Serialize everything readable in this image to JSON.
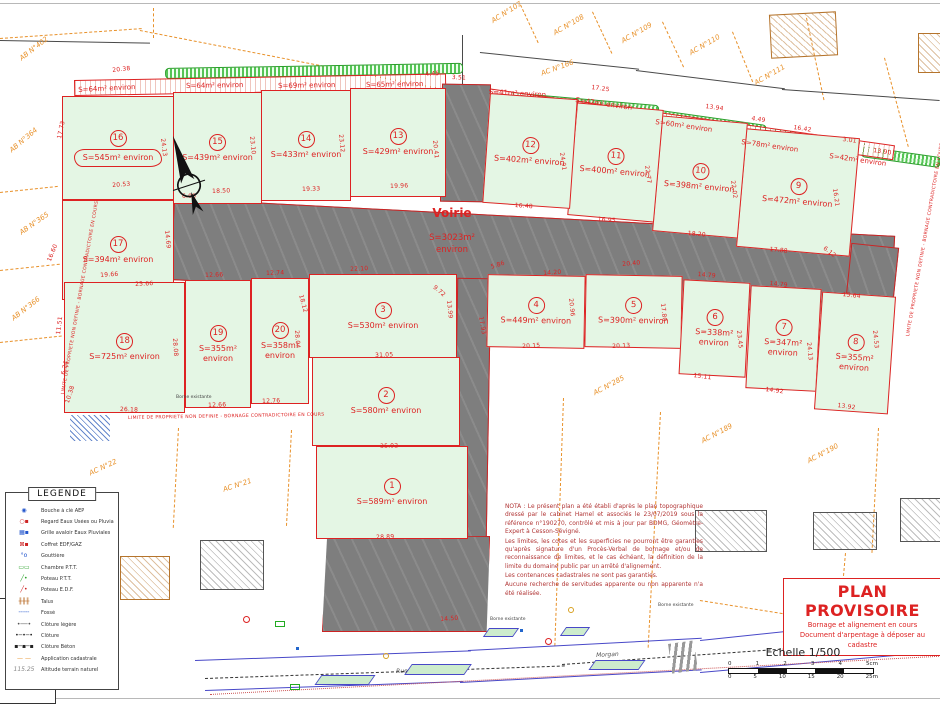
{
  "colors": {
    "lot_fill": "#e4f6e4",
    "boundary_red": "#dd2222",
    "voirie_gray": "#7e7e7e",
    "cadastre_orange": "#e8912a",
    "hedge_green": "#33aa33",
    "street_blue": "#4848c8",
    "stamp_red": "#dd2222"
  },
  "voirie": {
    "name": "Voirie",
    "area": "S=3023m²",
    "environ": "environ"
  },
  "lots": [
    {
      "number": "1",
      "area": "S=589m² environ"
    },
    {
      "number": "2",
      "area": "S=580m² environ"
    },
    {
      "number": "3",
      "area": "S=530m² environ"
    },
    {
      "number": "4",
      "area": "S=449m² environ"
    },
    {
      "number": "5",
      "area": "S=390m² environ"
    },
    {
      "number": "6",
      "area": "S=338m² environ"
    },
    {
      "number": "7",
      "area": "S=347m² environ"
    },
    {
      "number": "8",
      "area": "S=355m² environ"
    },
    {
      "number": "9",
      "area": "S=472m² environ"
    },
    {
      "number": "10",
      "area": "S=398m² environ"
    },
    {
      "number": "11",
      "area": "S=400m² environ"
    },
    {
      "number": "12",
      "area": "S=402m² environ"
    },
    {
      "number": "13",
      "area": "S=429m² environ"
    },
    {
      "number": "14",
      "area": "S=433m² environ"
    },
    {
      "number": "15",
      "area": "S=439m² environ"
    },
    {
      "number": "16",
      "area": "S=545m² environ"
    },
    {
      "number": "17",
      "area": "S=394m² environ"
    },
    {
      "number": "18",
      "area": "S=725m² environ"
    },
    {
      "number": "19",
      "area": "S=355m² environ"
    },
    {
      "number": "20",
      "area": "S=358m² environ"
    }
  ],
  "strip_lots": [
    "S=64m² environ",
    "S=64m² environ",
    "S=69m² environ",
    "S=65m² environ",
    "S=41m² environ",
    "S=47m² environ",
    "S=60m² environ",
    "S=78m² environ",
    "S=42m² environ"
  ],
  "parcels": {
    "ab402": "AB N°402",
    "ab364": "AB N°364",
    "ab365": "AB N°365",
    "ab366": "AB N°366",
    "ac107": "AC N°107",
    "ac108": "AC N°108",
    "ac109": "AC N°109",
    "ac110": "AC N°110",
    "ac111": "AC N°111",
    "ac166": "AC N°166",
    "ac248": "AC N°248",
    "ac285": "AC N°285",
    "ac189": "AC N°189",
    "ac190": "AC N°190",
    "ac21": "AC N°21",
    "ac22": "AC N°22"
  },
  "boundary_note": "LIMITE DE PROPRIETE NON DEFINIE - BORNAGE CONTRADICTOIRE EN COURS",
  "m": [
    "20.38",
    "4.45",
    "3.51",
    "17.25",
    "13.94",
    "4.49",
    "16.42",
    "3.01",
    "13.90",
    "17.73",
    "24.13",
    "23.10",
    "23.12",
    "20.41",
    "20.53",
    "6.00",
    "18.50",
    "19.33",
    "19.96",
    "24.91",
    "22.77",
    "22.02",
    "16.21",
    "16.48",
    "16.95",
    "18.20",
    "17.88",
    "6.12",
    "19.66",
    "25.66",
    "12.66",
    "12.74",
    "22.10",
    "9.72",
    "5.86",
    "14.20",
    "20.40",
    "14.79",
    "14.79",
    "15.64",
    "28.08",
    "28.04",
    "18.12",
    "31.05",
    "35.02",
    "28.89",
    "26.18",
    "12.66",
    "12.76",
    "20.15",
    "20.13",
    "15.11",
    "14.92",
    "13.92",
    "11.51",
    "6.24",
    "10.38",
    "16.60",
    "14.69",
    "24.53",
    "20.96",
    "17.80",
    "23.45",
    "24.13",
    "14.50",
    "17.93",
    "13.99"
  ],
  "legend": {
    "title": "LEGENDE",
    "items": [
      {
        "name": "bouche-a-cle-aep",
        "glyph": "◉",
        "color": "#2255cc",
        "label": "Bouche à clé AEP"
      },
      {
        "name": "regard-eaux",
        "glyph": "○▪",
        "color": "#cc2222",
        "label": "Regard Eaux Usées ou Pluviales"
      },
      {
        "name": "grille-avaloir",
        "glyph": "▦▪",
        "color": "#2255cc",
        "label": "Grille avaloir Eaux Pluviales"
      },
      {
        "name": "coffret-edf-gaz",
        "glyph": "⊠▪",
        "color": "#cc2222",
        "label": "Coffret EDF/GAZ"
      },
      {
        "name": "gouttiere",
        "glyph": "°o",
        "color": "#2255cc",
        "label": "Gouttière"
      },
      {
        "name": "chambre-ptt",
        "glyph": "▭▭",
        "color": "#2aa22a",
        "label": "Chambre P.T.T."
      },
      {
        "name": "poteau-ptt",
        "glyph": "╱•",
        "color": "#2aa22a",
        "label": "Poteau P.T.T."
      },
      {
        "name": "poteau-edf",
        "glyph": "╱•",
        "color": "#cc2222",
        "label": "Poteau E.D.F."
      },
      {
        "name": "talus",
        "glyph": "╫╫╫",
        "color": "#b5651d",
        "label": "Talus"
      },
      {
        "name": "fosse",
        "glyph": "╌╌╌",
        "color": "#2255cc",
        "label": "Fossé"
      },
      {
        "name": "cloture-legere",
        "glyph": "•──•",
        "color": "#555555",
        "label": "Clôture légère"
      },
      {
        "name": "cloture",
        "glyph": "•─•─•",
        "color": "#222222",
        "label": "Clôture"
      },
      {
        "name": "cloture-beton",
        "glyph": "▪─▪─▪",
        "color": "#222222",
        "label": "Clôture Béton"
      },
      {
        "name": "application-cadastrale",
        "glyph": "— —",
        "color": "#e8912a",
        "label": "Application cadastrale"
      },
      {
        "name": "altitude-terrain",
        "glyph": "115.25",
        "color": "#888888",
        "label": "Altitude terrain naturel"
      }
    ]
  },
  "nota": {
    "p1": "NOTA : Le présent plan a été établi d'après le plan topographique dressé par le cabinet Hamel et associés le 23/07/2019 sous la référence n°190270, contrôlé et mis à jour par BDMG, Géomètre-Expert à Cesson-Sévigné.",
    "p2": "Les limites, les cotes et les superficies ne pourront être garanties qu'après signature d'un Procès-Verbal de bornage et/ou de reconnaissance de limites, et le cas échéant, la définition de la limite du domaine public par un arrêté d'alignement.",
    "p3": "Les contenances cadastrales ne sont pas garanties.",
    "p4": "Aucune recherche de servitudes apparente ou non apparente n'a été réalisée."
  },
  "stamp": {
    "title": "PLAN PROVISOIRE",
    "line1": "Bornage et alignement en cours",
    "line2": "Document d'arpentage à déposer au cadastre"
  },
  "scale": {
    "label": "Echelle 1/500",
    "cm": [
      "0",
      "1",
      "2",
      "3",
      "4",
      "5cm"
    ],
    "m": [
      "0",
      "5",
      "10",
      "15",
      "20",
      "25m"
    ]
  },
  "street": {
    "label1": "Rue",
    "label2": "Morgan"
  },
  "misc": {
    "borne": "Borne existante"
  }
}
